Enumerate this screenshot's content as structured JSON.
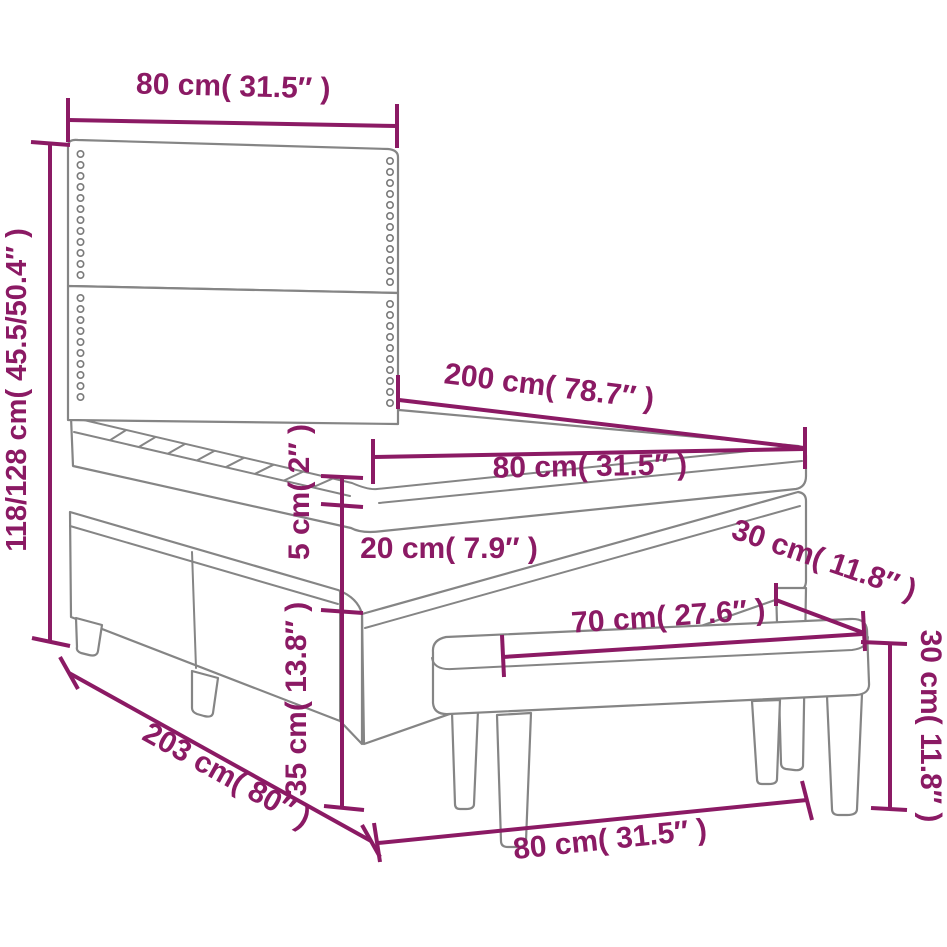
{
  "page": {
    "type": "product-dimension-diagram",
    "background": "#ffffff"
  },
  "colors": {
    "dimension": "#8b1a64",
    "outline": "#858585"
  },
  "drawing": {
    "elements": [
      "headboard",
      "pillow-top-mattress",
      "box-spring-base",
      "bed-legs",
      "bench"
    ]
  },
  "dimensions": [
    {
      "id": "headboard_width",
      "cm": "80",
      "in": "31.5",
      "label": "80 cm( 31.5″ )"
    },
    {
      "id": "total_height",
      "cm": "118/128",
      "in": "45.5/50.4",
      "label": "118/128 cm( 45.5/50.4″ )"
    },
    {
      "id": "bed_length",
      "cm": "200",
      "in": "78.7",
      "label": "200 cm( 78.7″ )"
    },
    {
      "id": "mattress_width",
      "cm": "80",
      "in": "31.5",
      "label": "80 cm( 31.5″ )"
    },
    {
      "id": "topper_thickness",
      "cm": "5",
      "in": "2",
      "label": "5 cm( 2″ )"
    },
    {
      "id": "mattress_thickness",
      "cm": "20",
      "in": "7.9",
      "label": "20 cm( 7.9″ )"
    },
    {
      "id": "bench_depth",
      "cm": "30",
      "in": "11.8",
      "label": "30 cm( 11.8″ )"
    },
    {
      "id": "base_height",
      "cm": "35",
      "in": "13.8",
      "label": "35 cm( 13.8″ )"
    },
    {
      "id": "bench_length",
      "cm": "70",
      "in": "27.6",
      "label": "70 cm( 27.6″ )"
    },
    {
      "id": "bench_height",
      "cm": "30",
      "in": "11.8",
      "label": "30 cm( 11.8″ )"
    },
    {
      "id": "total_length",
      "cm": "203",
      "in": "80",
      "label": "203 cm( 80″ )"
    },
    {
      "id": "total_width",
      "cm": "80",
      "in": "31.5",
      "label": "80 cm( 31.5″ )"
    }
  ]
}
